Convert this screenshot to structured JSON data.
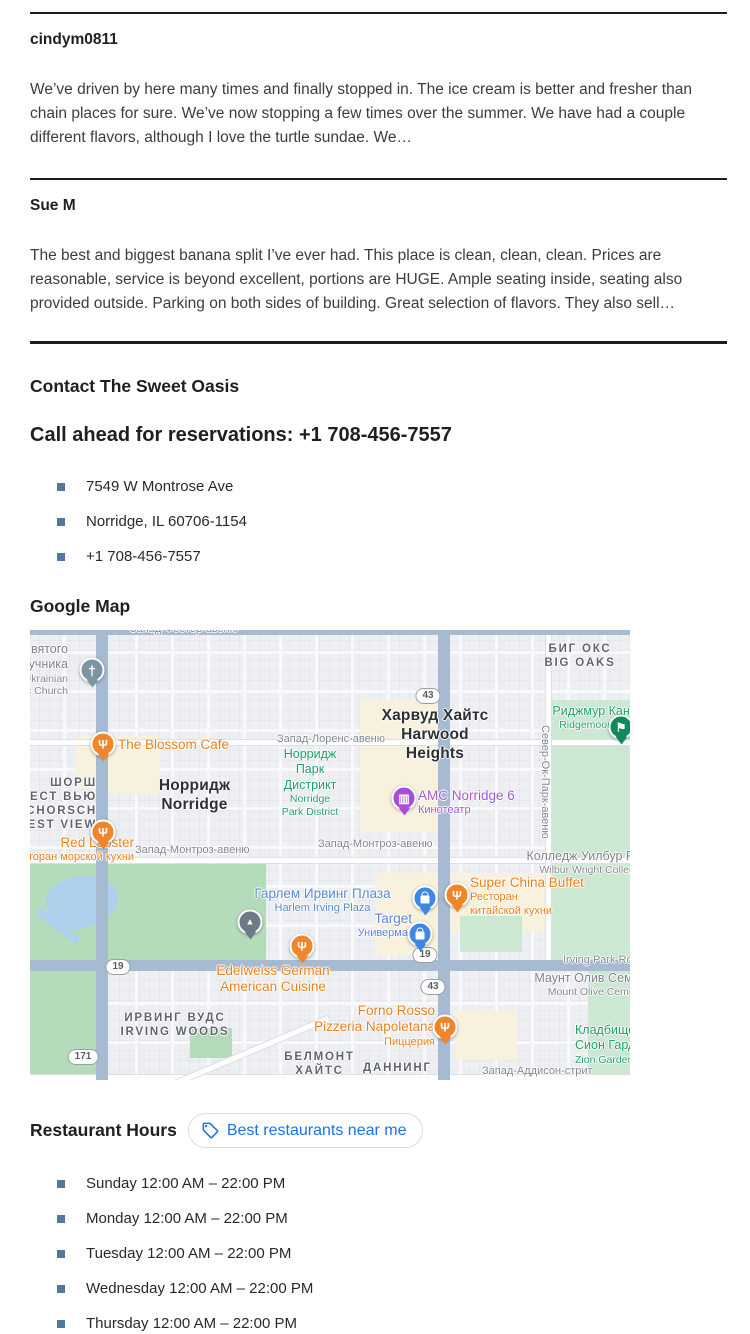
{
  "reviews": [
    {
      "author": "cindym0811",
      "text": "We’ve driven by here many times and finally stopped in. The ice cream is better and fresher than chain places for sure. We’ve now stopping a few times over the summer. We have had a couple different flavors, although I love the turtle sundae. We…"
    },
    {
      "author": "Sue M",
      "text": "The best and biggest banana split I’ve ever had. This place is clean, clean, clean. Prices are reasonable, service is beyond excellent, portions are HUGE. Ample seating inside, seating also provided outside. Parking on both sides of building. Great selection of flavors. They also sell…"
    }
  ],
  "contact": {
    "heading": "Contact The Sweet Oasis",
    "call_ahead": "Call ahead for reservations: +1 708-456-7557",
    "items": [
      "7549 W Montrose Ave",
      "Norridge, IL 60706-1154",
      "+1 708-456-7557"
    ]
  },
  "map_section": {
    "heading": "Google Map"
  },
  "hours": {
    "heading": "Restaurant Hours",
    "button_label": "Best restaurants near me",
    "items": [
      "Sunday 12:00 AM – 22:00 PM",
      "Monday 12:00 AM – 22:00 PM",
      "Tuesday 12:00 AM – 22:00 PM",
      "Wednesday 12:00 AM – 22:00 PM",
      "Thursday 12:00 AM – 22:00 PM"
    ]
  },
  "colors": {
    "accent_blue": "#1a73e8",
    "bullet_square": "#54779e",
    "poi_orange": "#eb801c",
    "poi_blue": "#5d87d4",
    "poi_purple": "#a05bcf",
    "park_green": "#1d9e63"
  },
  "map": {
    "labels": [
      {
        "x": 100,
        "y": -7,
        "c": "street",
        "l": [
          [
            "Запад-Фостер-авеню",
            "m"
          ]
        ]
      },
      {
        "x": -70,
        "y": 12,
        "w": 108,
        "a": "right",
        "c": "cem",
        "l": [
          [
            "Святого",
            "m"
          ],
          [
            "Обручника",
            "m"
          ],
          [
            "Ukrainian",
            "s"
          ],
          [
            "Catholic Church",
            "s"
          ]
        ]
      },
      {
        "x": 495,
        "y": 12,
        "w": 110,
        "a": "center",
        "c": "district",
        "l": [
          [
            "БИГ ОКС",
            "m"
          ],
          [
            "BIG OAKS",
            "m"
          ]
        ]
      },
      {
        "x": 487,
        "y": 74,
        "w": 200,
        "a": "center",
        "c": "park",
        "l": [
          [
            "Риджмур Кантри Клаб",
            "m"
          ],
          [
            "Ridgemoor Country Club",
            "s"
          ]
        ]
      },
      {
        "x": 330,
        "y": 77,
        "w": 150,
        "a": "center",
        "c": "city",
        "l": [
          [
            "Харвуд Хайтс",
            "m"
          ],
          [
            "Harwood",
            "m"
          ],
          [
            "Heights",
            "m"
          ]
        ]
      },
      {
        "x": 88,
        "y": 107,
        "c": "poiOrange",
        "l": [
          [
            "The Blossom Cafe",
            "m"
          ]
        ]
      },
      {
        "x": 247,
        "y": 103,
        "c": "street",
        "l": [
          [
            "Запад-Лоренс-авеню",
            "m"
          ]
        ]
      },
      {
        "x": 225,
        "y": 117,
        "w": 110,
        "a": "center",
        "c": "park",
        "l": [
          [
            "Норридж",
            "m"
          ],
          [
            "Парк",
            "m"
          ],
          [
            "Дистрикт",
            "m"
          ],
          [
            "Norridge",
            "s"
          ],
          [
            "Park District",
            "s"
          ]
        ]
      },
      {
        "x": 112,
        "y": 147,
        "w": 105,
        "a": "center",
        "c": "city",
        "l": [
          [
            "Норридж",
            "m"
          ],
          [
            "Norridge",
            "m"
          ]
        ]
      },
      {
        "x": -58,
        "y": 146,
        "w": 125,
        "a": "right",
        "c": "district",
        "l": [
          [
            "ШОРШ",
            "m"
          ],
          [
            "ФОРЕСТ ВЬЮ",
            "m"
          ],
          [
            "SCHORSCH",
            "m"
          ],
          [
            "FOREST VIEW",
            "m"
          ]
        ]
      },
      {
        "x": 388,
        "y": 158,
        "c": "poiPurple",
        "l": [
          [
            "AMC Norridge 6",
            "m"
          ],
          [
            "Кинотеатр",
            "s"
          ]
        ]
      },
      {
        "x": 521,
        "y": 95,
        "c": "street",
        "rot": 1,
        "l": [
          [
            "Север-Ок-Парк-авеню",
            "m"
          ]
        ]
      },
      {
        "x": -48,
        "y": 205,
        "w": 152,
        "a": "right",
        "c": "poiOrange",
        "l": [
          [
            "Red Lobster",
            "m"
          ],
          [
            "Ресторан морской кухни",
            "s"
          ]
        ]
      },
      {
        "x": 105,
        "y": 214,
        "c": "street",
        "l": [
          [
            "Запад-Монтроз-авеню",
            "m"
          ]
        ]
      },
      {
        "x": 288,
        "y": 208,
        "c": "street",
        "l": [
          [
            "Запад-Монтроз-авеню",
            "m"
          ]
        ]
      },
      {
        "x": 460,
        "y": 219,
        "w": 200,
        "a": "center",
        "c": "cem",
        "l": [
          [
            "Колледж Уилбур Райт",
            "m"
          ],
          [
            "Wilbur Wright College",
            "s"
          ]
        ]
      },
      {
        "x": 205,
        "y": 256,
        "w": 175,
        "a": "center",
        "c": "poiBlue",
        "l": [
          [
            "Гарлем Ирвинг Плаза",
            "m"
          ],
          [
            "Harlem Irving Plaza",
            "s"
          ]
        ]
      },
      {
        "x": 440,
        "y": 245,
        "c": "poiOrange",
        "l": [
          [
            "Super China Buffet",
            "m"
          ],
          [
            "Ресторан",
            "s"
          ],
          [
            "китайской кухни",
            "s"
          ]
        ]
      },
      {
        "x": 282,
        "y": 281,
        "w": 100,
        "a": "right",
        "c": "poiBlue",
        "l": [
          [
            "Target",
            "m"
          ],
          [
            "Универмаг",
            "s"
          ]
        ]
      },
      {
        "x": 533,
        "y": 324,
        "c": "street",
        "l": [
          [
            "Irving Park Rd",
            "m"
          ]
        ]
      },
      {
        "x": 495,
        "y": 341,
        "w": 150,
        "a": "center",
        "c": "cem",
        "l": [
          [
            "Маунт Олив Семетери",
            "m"
          ],
          [
            "Mount Olive Cemetery",
            "s"
          ]
        ]
      },
      {
        "x": 178,
        "y": 333,
        "w": 130,
        "a": "center",
        "c": "poiOrange",
        "l": [
          [
            "Edelweiss German",
            "m"
          ],
          [
            "American Cuisine",
            "m"
          ]
        ]
      },
      {
        "x": 85,
        "y": 381,
        "w": 120,
        "a": "center",
        "c": "district",
        "l": [
          [
            "ИРВИНГ ВУДС",
            "m"
          ],
          [
            "IRVING WOODS",
            "m"
          ]
        ]
      },
      {
        "x": 278,
        "y": 373,
        "w": 127,
        "a": "right",
        "c": "poiOrange",
        "l": [
          [
            "Forno Rosso",
            "m"
          ],
          [
            "Pizzeria Napoletana",
            "m"
          ],
          [
            "Пиццерия",
            "s"
          ]
        ]
      },
      {
        "x": 252,
        "y": 420,
        "w": 75,
        "a": "center",
        "c": "district",
        "l": [
          [
            "БЕЛМОНТ",
            "m"
          ],
          [
            "ХАЙТС",
            "m"
          ]
        ]
      },
      {
        "x": 333,
        "y": 431,
        "w": 65,
        "a": "center",
        "c": "district",
        "l": [
          [
            "ДАННИНГ",
            "m"
          ]
        ]
      },
      {
        "x": 452,
        "y": 435,
        "c": "street",
        "l": [
          [
            "Запад-Аддисон-стрит",
            "m"
          ]
        ]
      },
      {
        "x": 545,
        "y": 393,
        "c": "park",
        "l": [
          [
            "Кладбище",
            "m"
          ],
          [
            "Сион Гарденс",
            "m"
          ],
          [
            "Zion Gardens Cemetery",
            "s"
          ]
        ]
      }
    ],
    "pins": [
      {
        "x": 62,
        "y": 40,
        "t": "church",
        "col": "#7c95a3"
      },
      {
        "x": 591,
        "y": 97,
        "t": "golf",
        "col": "#0f8a5f"
      },
      {
        "x": 73,
        "y": 114,
        "t": "restaurant",
        "col": "#f0862c"
      },
      {
        "x": 73,
        "y": 202,
        "t": "restaurant",
        "col": "#f0862c"
      },
      {
        "x": 374,
        "y": 168,
        "t": "movie",
        "col": "#a64fd6"
      },
      {
        "x": 220,
        "y": 292,
        "t": "monument",
        "col": "#6d7a85"
      },
      {
        "x": 395,
        "y": 268,
        "t": "shopping",
        "col": "#3f87e5"
      },
      {
        "x": 427,
        "y": 265,
        "t": "restaurant",
        "col": "#f0862c"
      },
      {
        "x": 390,
        "y": 304,
        "t": "shopping",
        "col": "#3f87e5"
      },
      {
        "x": 272,
        "y": 316,
        "t": "restaurant",
        "col": "#f0862c"
      },
      {
        "x": 415,
        "y": 397,
        "t": "restaurant",
        "col": "#f0862c"
      }
    ],
    "shields": [
      {
        "x": 398,
        "y": 66,
        "t": "43"
      },
      {
        "x": 88,
        "y": 337,
        "t": "19"
      },
      {
        "x": 395,
        "y": 325,
        "t": "19"
      },
      {
        "x": 403,
        "y": 357,
        "t": "43"
      },
      {
        "x": 53,
        "y": 427,
        "t": "171"
      }
    ]
  }
}
